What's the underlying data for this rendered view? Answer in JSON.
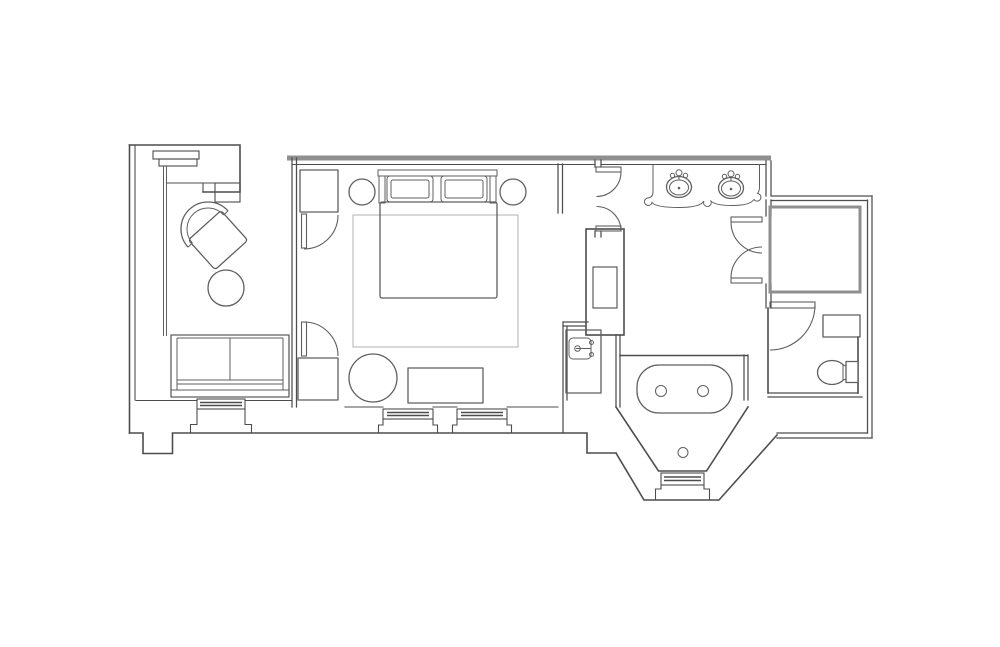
{
  "document": {
    "kind": "architectural-floor-plan",
    "description": "Line-drawing floor plan of a hotel guest suite; no text labels are rendered in the image",
    "canvas": {
      "width": 1000,
      "height": 647
    },
    "visible_text": []
  },
  "palette": {
    "background": "#ffffff",
    "wall_line": "#4d4d4d",
    "wall_band": "#8f8f8f",
    "furniture_line": "#5f5f5f",
    "rug_line": "#b8b8b8"
  },
  "rooms": [
    {
      "name": "entry-closet-nook",
      "location": "top-left"
    },
    {
      "name": "sitting-area",
      "location": "left",
      "contents": [
        "armchair",
        "round-side-table",
        "sofa",
        "bay-window"
      ]
    },
    {
      "name": "bedroom",
      "location": "center",
      "contents": [
        "king-bed",
        "two-pillows",
        "two-round-nightstands",
        "area-rug",
        "two-wardrobe-closets",
        "round-table",
        "bench",
        "two-bay-windows"
      ]
    },
    {
      "name": "hallway-vestibule",
      "location": "center-right",
      "contents": [
        "service-column",
        "wet-bar-sink",
        "double-swing-doors"
      ]
    },
    {
      "name": "bathroom",
      "location": "right",
      "contents": [
        "double-vanity",
        "two-oval-sinks",
        "bathtub-in-bay",
        "bay-window"
      ]
    },
    {
      "name": "shower-room",
      "location": "far-right-top",
      "contents": [
        "double-doors"
      ]
    },
    {
      "name": "water-closet",
      "location": "far-right-bottom",
      "contents": [
        "toilet",
        "shelf",
        "swing-door"
      ]
    }
  ],
  "fixtures": {
    "sinks": 3,
    "toilets": 1,
    "bathtubs": 1,
    "windows": 4,
    "door_swings": 6,
    "closets": 3
  }
}
